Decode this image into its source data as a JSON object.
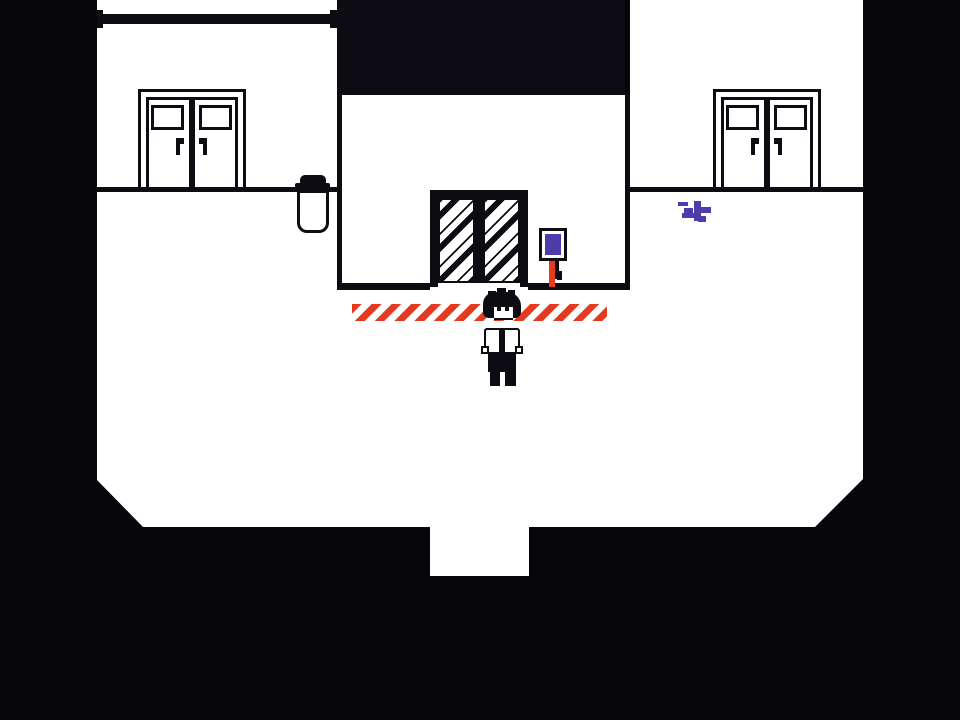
{
  "app": {
    "name": "monochrome pixel-art adventure game",
    "scene": "lobby room with elevator, two double doors, sign, trash can and player"
  },
  "palette": {
    "background": "#06060a",
    "ink": "#0c0c12",
    "paper": "#ffffff",
    "red": "#e63a20",
    "purple": "#4c3dab"
  },
  "scene": {
    "visible_text": [],
    "objects": [
      {
        "name": "double-door-west",
        "type": "double swing doors with windows and handles"
      },
      {
        "name": "double-door-east",
        "type": "double swing doors with windows and handles"
      },
      {
        "name": "elevator-door",
        "type": "recessed sliding door with diagonal hatched panels"
      },
      {
        "name": "trash-can",
        "type": "lidded bin beside west wall"
      },
      {
        "name": "wall-sign",
        "type": "purple sign on short red post"
      },
      {
        "name": "paint-splatter",
        "type": "purple splatter on floor"
      },
      {
        "name": "hazard-line",
        "type": "red diagonal warning stripes on floor"
      },
      {
        "name": "player",
        "type": "pixel character with messy hair, white shirt, dark pants"
      }
    ]
  }
}
